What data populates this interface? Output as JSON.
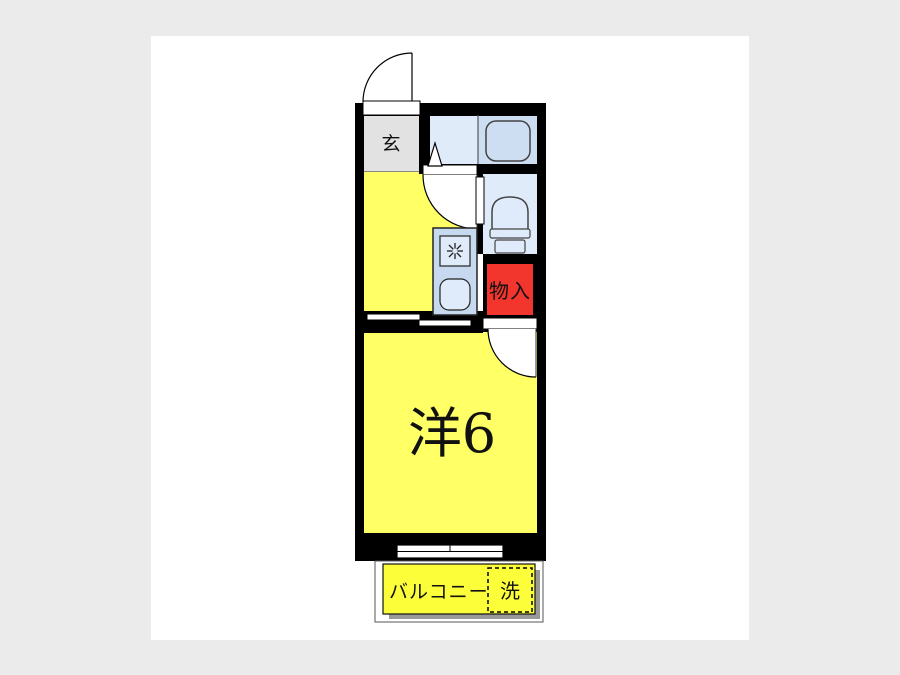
{
  "page": {
    "background": "#ebebeb",
    "panel": "#ffffff"
  },
  "floorplan": {
    "labels": {
      "entrance": "玄",
      "storage": "物入",
      "main_room": "洋6",
      "balcony": "バルコニー",
      "washer": "洗"
    },
    "colors": {
      "wall": "#000000",
      "entrance_floor": "#e2e2e2",
      "room_yellow": "#ffff66",
      "balcony_yellow": "#fcfe39",
      "washroom_blue": "#e0ebfa",
      "bath_blue": "#cddef3",
      "fixture_blue": "#dfeafa",
      "kitchen_unit_blue": "#c7d9ef",
      "storage_red": "#f2362e",
      "balcony_shadow": "#999999"
    }
  }
}
